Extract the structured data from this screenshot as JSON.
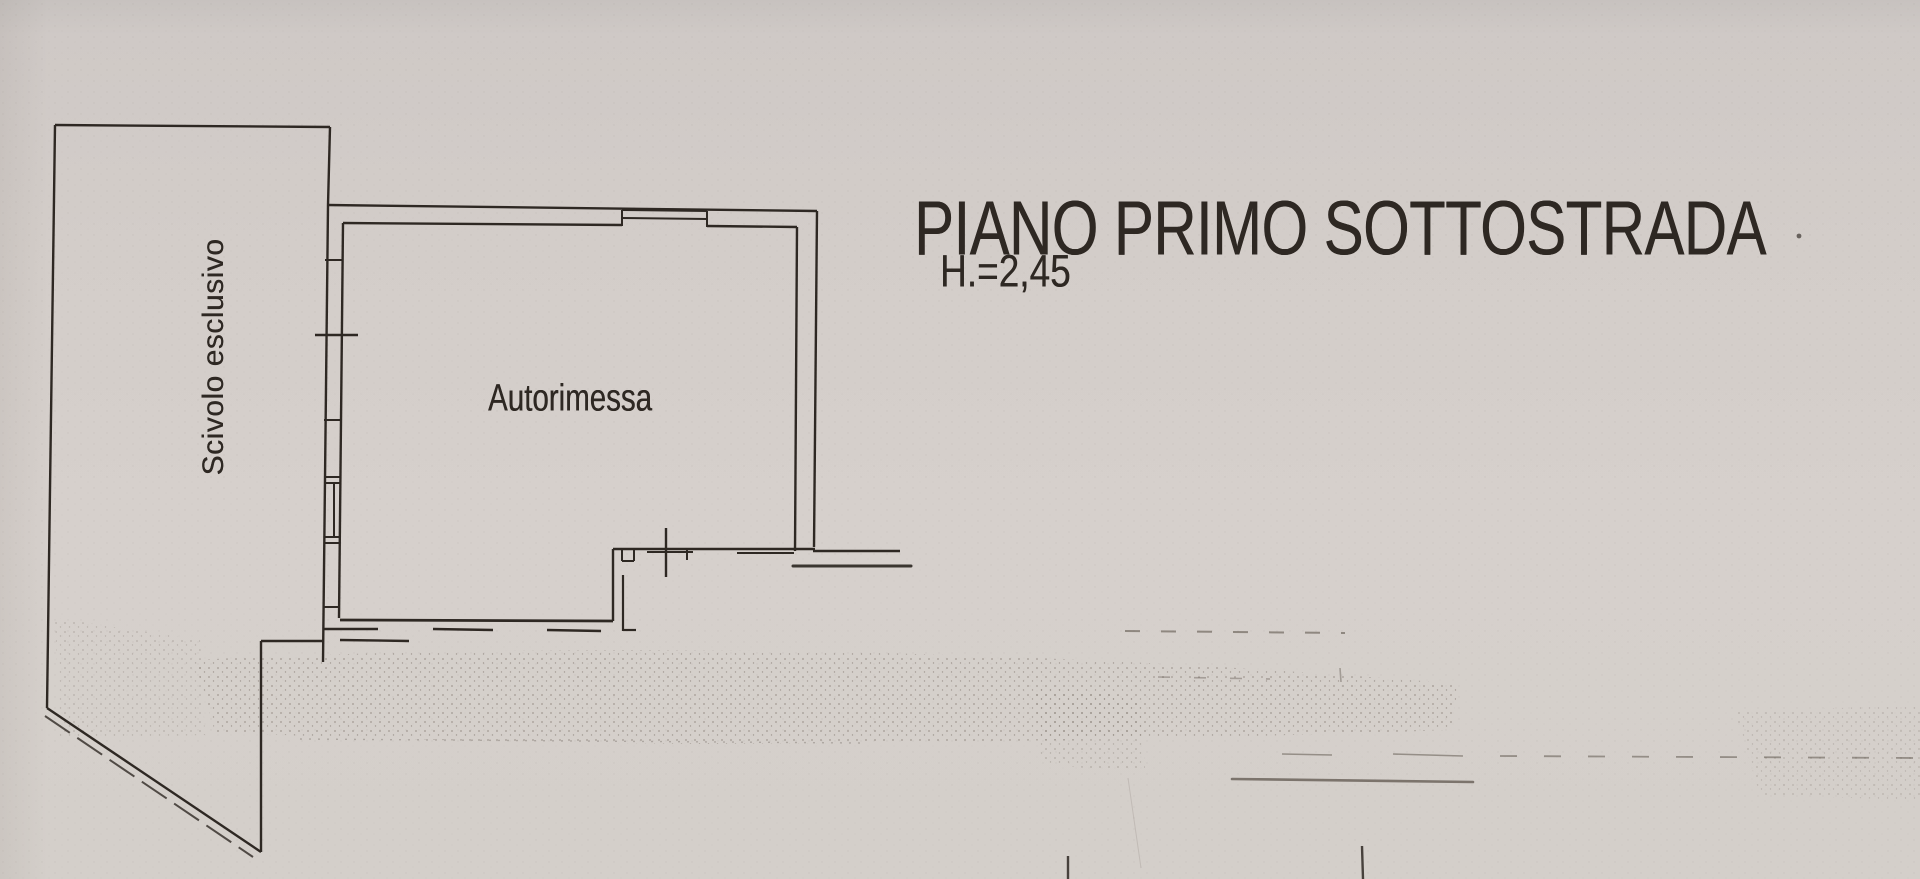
{
  "plan": {
    "title": "PIANO PRIMO SOTTOSTRADA",
    "height_note": "H.=2,45",
    "room_label": "Autorimessa",
    "area_label": "Scivolo esclusivo"
  },
  "colors": {
    "paper": "#d2ccc8",
    "ink": "#2e2823",
    "faint_ink": "#564d44"
  }
}
